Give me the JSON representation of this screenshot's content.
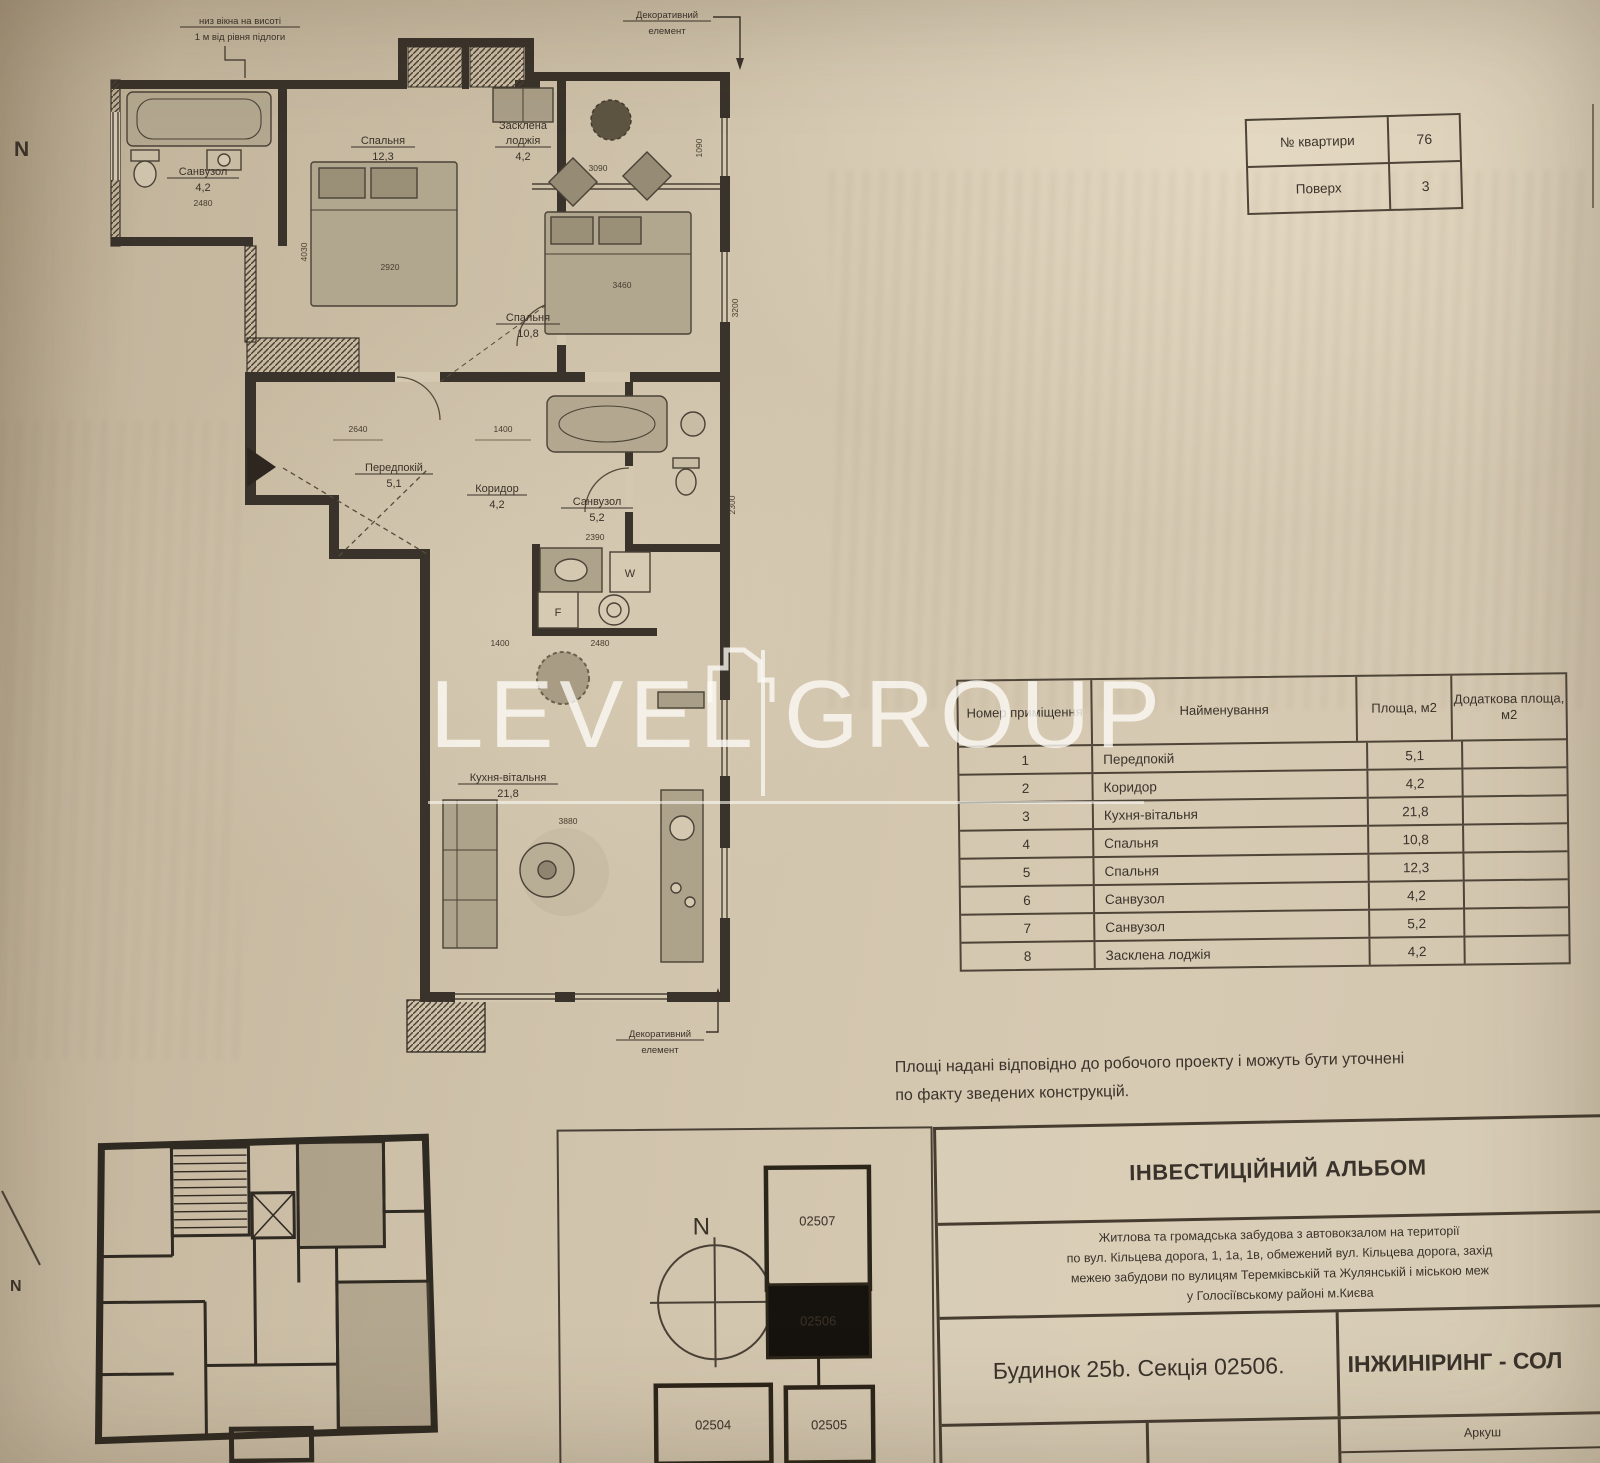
{
  "compass": {
    "top_left_n": "N",
    "bottom_left_n": "N"
  },
  "watermark": {
    "word_left": "LEVEL",
    "word_right": "GROUP"
  },
  "apt_info": {
    "rows": [
      {
        "label": "№ квартири",
        "value": "76"
      },
      {
        "label": "Поверх",
        "value": "3"
      }
    ]
  },
  "plan": {
    "window_note_line1": "низ вікна на висоті",
    "window_note_line2": "1 м від рівня підлоги",
    "decor_top_line1": "Декоративний",
    "decor_top_line2": "елемент",
    "decor_bottom_line1": "Декоративний",
    "decor_bottom_line2": "елемент",
    "rooms": {
      "bath1": {
        "name": "Санвузол",
        "area": "4,2"
      },
      "bedroom1": {
        "name": "Спальня",
        "area": "12,3"
      },
      "loggia": {
        "line1": "Засклена",
        "line2": "лоджія",
        "area": "4,2"
      },
      "bedroom2": {
        "name": "Спальня",
        "area": "10,8"
      },
      "hall": {
        "name": "Передпокій",
        "area": "5,1"
      },
      "corridor": {
        "name": "Коридор",
        "area": "4,2"
      },
      "bath2": {
        "name": "Санвузол",
        "area": "5,2"
      },
      "kitchen": {
        "name": "Кухня-вітальня",
        "area": "21,8"
      }
    },
    "appliances": {
      "washer": "W",
      "fridge": "F"
    },
    "dims": {
      "d2920": "2920",
      "d4030": "4030",
      "d3460": "3460",
      "d3090": "3090",
      "d1090": "1090",
      "d3200": "3200",
      "d2640": "2640",
      "d1400a": "1400",
      "d2480a": "2480",
      "d2390": "2390",
      "d2300": "2300",
      "d1400b": "1400",
      "d2480b": "2480",
      "d3880": "3880"
    }
  },
  "area_table": {
    "headers": {
      "num": "Номер приміщення",
      "name": "Найменування",
      "area": "Площа, м2",
      "extra": "Додаткова площа, м2"
    },
    "rows": [
      {
        "num": "1",
        "name": "Передпокій",
        "area": "5,1",
        "extra": ""
      },
      {
        "num": "2",
        "name": "Коридор",
        "area": "4,2",
        "extra": ""
      },
      {
        "num": "3",
        "name": "Кухня-вітальня",
        "area": "21,8",
        "extra": ""
      },
      {
        "num": "4",
        "name": "Спальня",
        "area": "10,8",
        "extra": ""
      },
      {
        "num": "5",
        "name": "Спальня",
        "area": "12,3",
        "extra": ""
      },
      {
        "num": "6",
        "name": "Санвузол",
        "area": "4,2",
        "extra": ""
      },
      {
        "num": "7",
        "name": "Санвузол",
        "area": "5,2",
        "extra": ""
      },
      {
        "num": "8",
        "name": "Засклена лоджія",
        "area": "4,2",
        "extra": ""
      }
    ]
  },
  "note": {
    "line1": "Площі надані відповідно до робочого проекту і можуть бути уточнені",
    "line2": "по факту зведених конструкцій."
  },
  "title_block": {
    "title": "ІНВЕСТИЦІЙНИЙ АЛЬБОМ",
    "desc_line1": "Житлова та громадська забудова з автовокзалом на території",
    "desc_line2": "по вул. Кільцева дорога, 1, 1а, 1в, обмежений вул. Кільцева дорога, захід",
    "desc_line3": "межею забудови по вулицям Теремківській та Жулянській і міською меж",
    "desc_line4": "у Голосіївському районі м.Києва",
    "building": "Будинок 25b. Секція 02506.",
    "company": "ІНЖИНІРИНГ - СОЛ",
    "doc_code": "2L_R3.3.76",
    "sheet_label": "Аркуш",
    "sheet_value": "21"
  },
  "section_key": {
    "n": "N",
    "top": "02507",
    "current": "02506",
    "bottom_left": "02504",
    "bottom_right": "02505"
  }
}
